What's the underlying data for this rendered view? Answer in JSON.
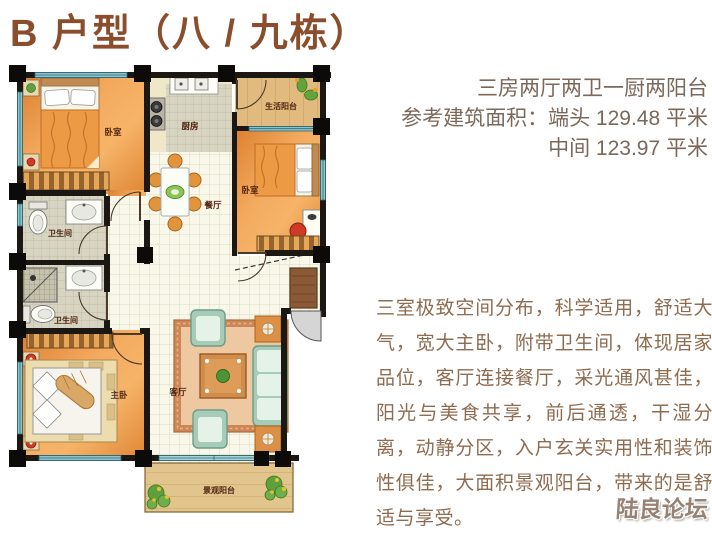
{
  "header": {
    "title": "B 户型（八 / 九栋）"
  },
  "specs": {
    "line1": "三房两厅两卫一厨两阳台",
    "line2": "参考建筑面积：端头 129.48 平米",
    "line3": "中间 123.97 平米"
  },
  "description": "三室极致空间分布，科学适用，舒适大气，宽大主卧，附带卫生间，体现居家品位，客厅连接餐厅，采光通风甚佳，阳光与美食共享，前后通透，干湿分离，动静分区，入户玄关实用性和装饰性俱佳，大面积景观阳台，带来的是舒适与享受。",
  "watermark": "陆良论坛",
  "floorplan": {
    "rooms": {
      "bedroom_top_left": "卧室",
      "kitchen": "厨房",
      "life_balcony": "生活阳台",
      "bedroom_right": "卧室",
      "dining": "餐厅",
      "bathroom_top": "卫生间",
      "bathroom_bottom": "卫生间",
      "master_bedroom": "主卧",
      "living_room": "客厅",
      "view_balcony": "景观阳台"
    },
    "colors": {
      "title_text": "#8a4e2c",
      "spec_text": "#7c685a",
      "description_text": "#8e6c50",
      "watermark_text": "#968373",
      "wall": "#1b1713",
      "window": "#8fc3cc",
      "bedroom_floor": "#ee9c4a",
      "balcony_wood": "#e0ba7e",
      "tile_light": "#f9f7e9",
      "tile_gray": "#d8d4c2",
      "sofa_green": "#a6cbb6",
      "rug": "#eec8a0",
      "accent_red": "#ce3a26"
    }
  }
}
